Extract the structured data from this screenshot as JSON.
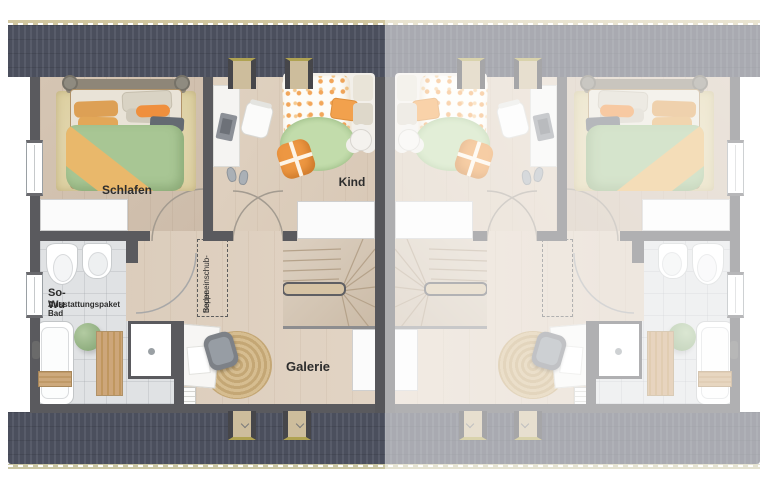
{
  "plan": {
    "rooms": {
      "bedroom": "Schlafen",
      "child": "Kind",
      "gallery": "Galerie"
    },
    "bath": {
      "title": "So-Wu",
      "subtitle": "Ausstattungspaket Bad"
    },
    "attic_stairs": {
      "line1": "Bodeneinschub-",
      "line2": "treppe"
    }
  },
  "colors": {
    "roof": "#4b4f5d",
    "roof_ridge": "#d2c7a0",
    "wall": "#5a5a5e",
    "wood_floor": "#dbccbb",
    "bath_tile": "#e0e2e4",
    "duvet_green": "#a8c694",
    "accent_orange": "#ef9a44",
    "rug_beige": "#e2d5b4",
    "rattan": "#d3b98c"
  }
}
